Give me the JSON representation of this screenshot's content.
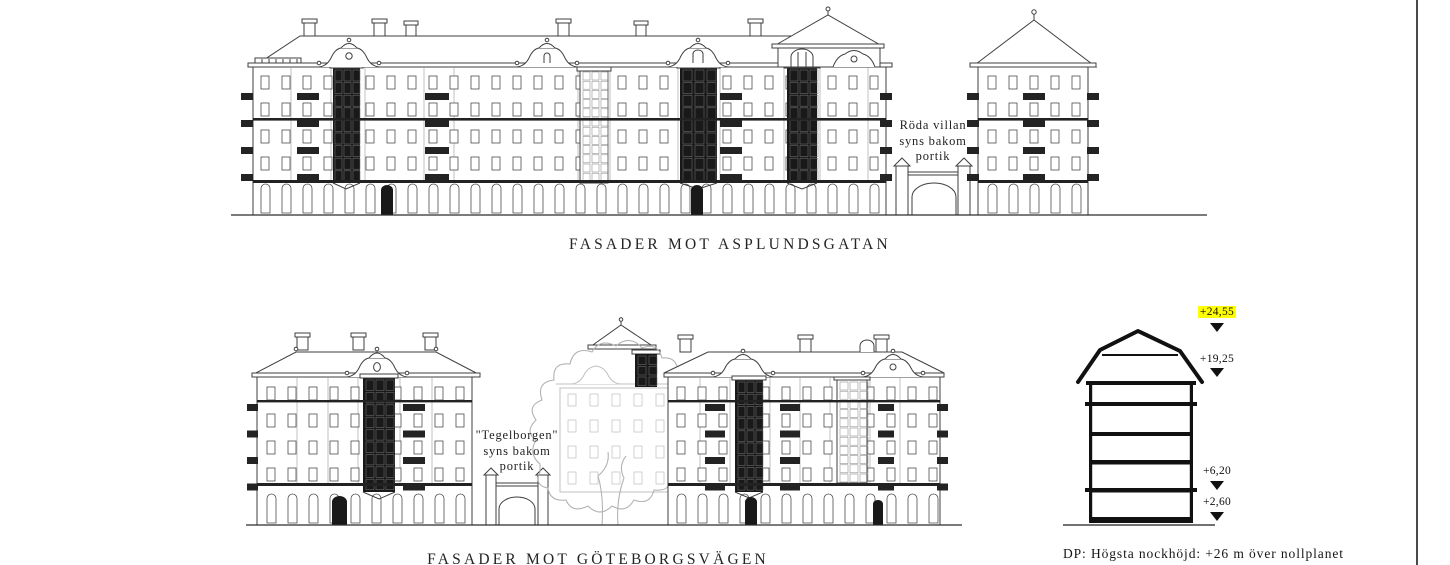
{
  "sheet": {
    "background": "#ffffff",
    "border_line_color": "#4a4a4a"
  },
  "top_facade": {
    "title": "FASADER MOT ASPLUNDSGATAN",
    "annotation_lines": [
      "Röda villan",
      "syns bakom",
      "portik"
    ]
  },
  "bottom_facade": {
    "title": "FASADER MOT GÖTEBORGSVÄGEN",
    "annotation_lines": [
      "\"Tegelborgen\"",
      "syns bakom",
      "portik"
    ]
  },
  "height_section": {
    "levels": [
      {
        "value": "+24,55",
        "highlighted": true
      },
      {
        "value": "+19,25",
        "highlighted": false
      },
      {
        "value": "+6,20",
        "highlighted": false
      },
      {
        "value": "+2,60",
        "highlighted": false
      }
    ],
    "highlight_color": "#ffff00",
    "note": "DP: Högsta nockhöjd: +26 m över nollplanet"
  }
}
